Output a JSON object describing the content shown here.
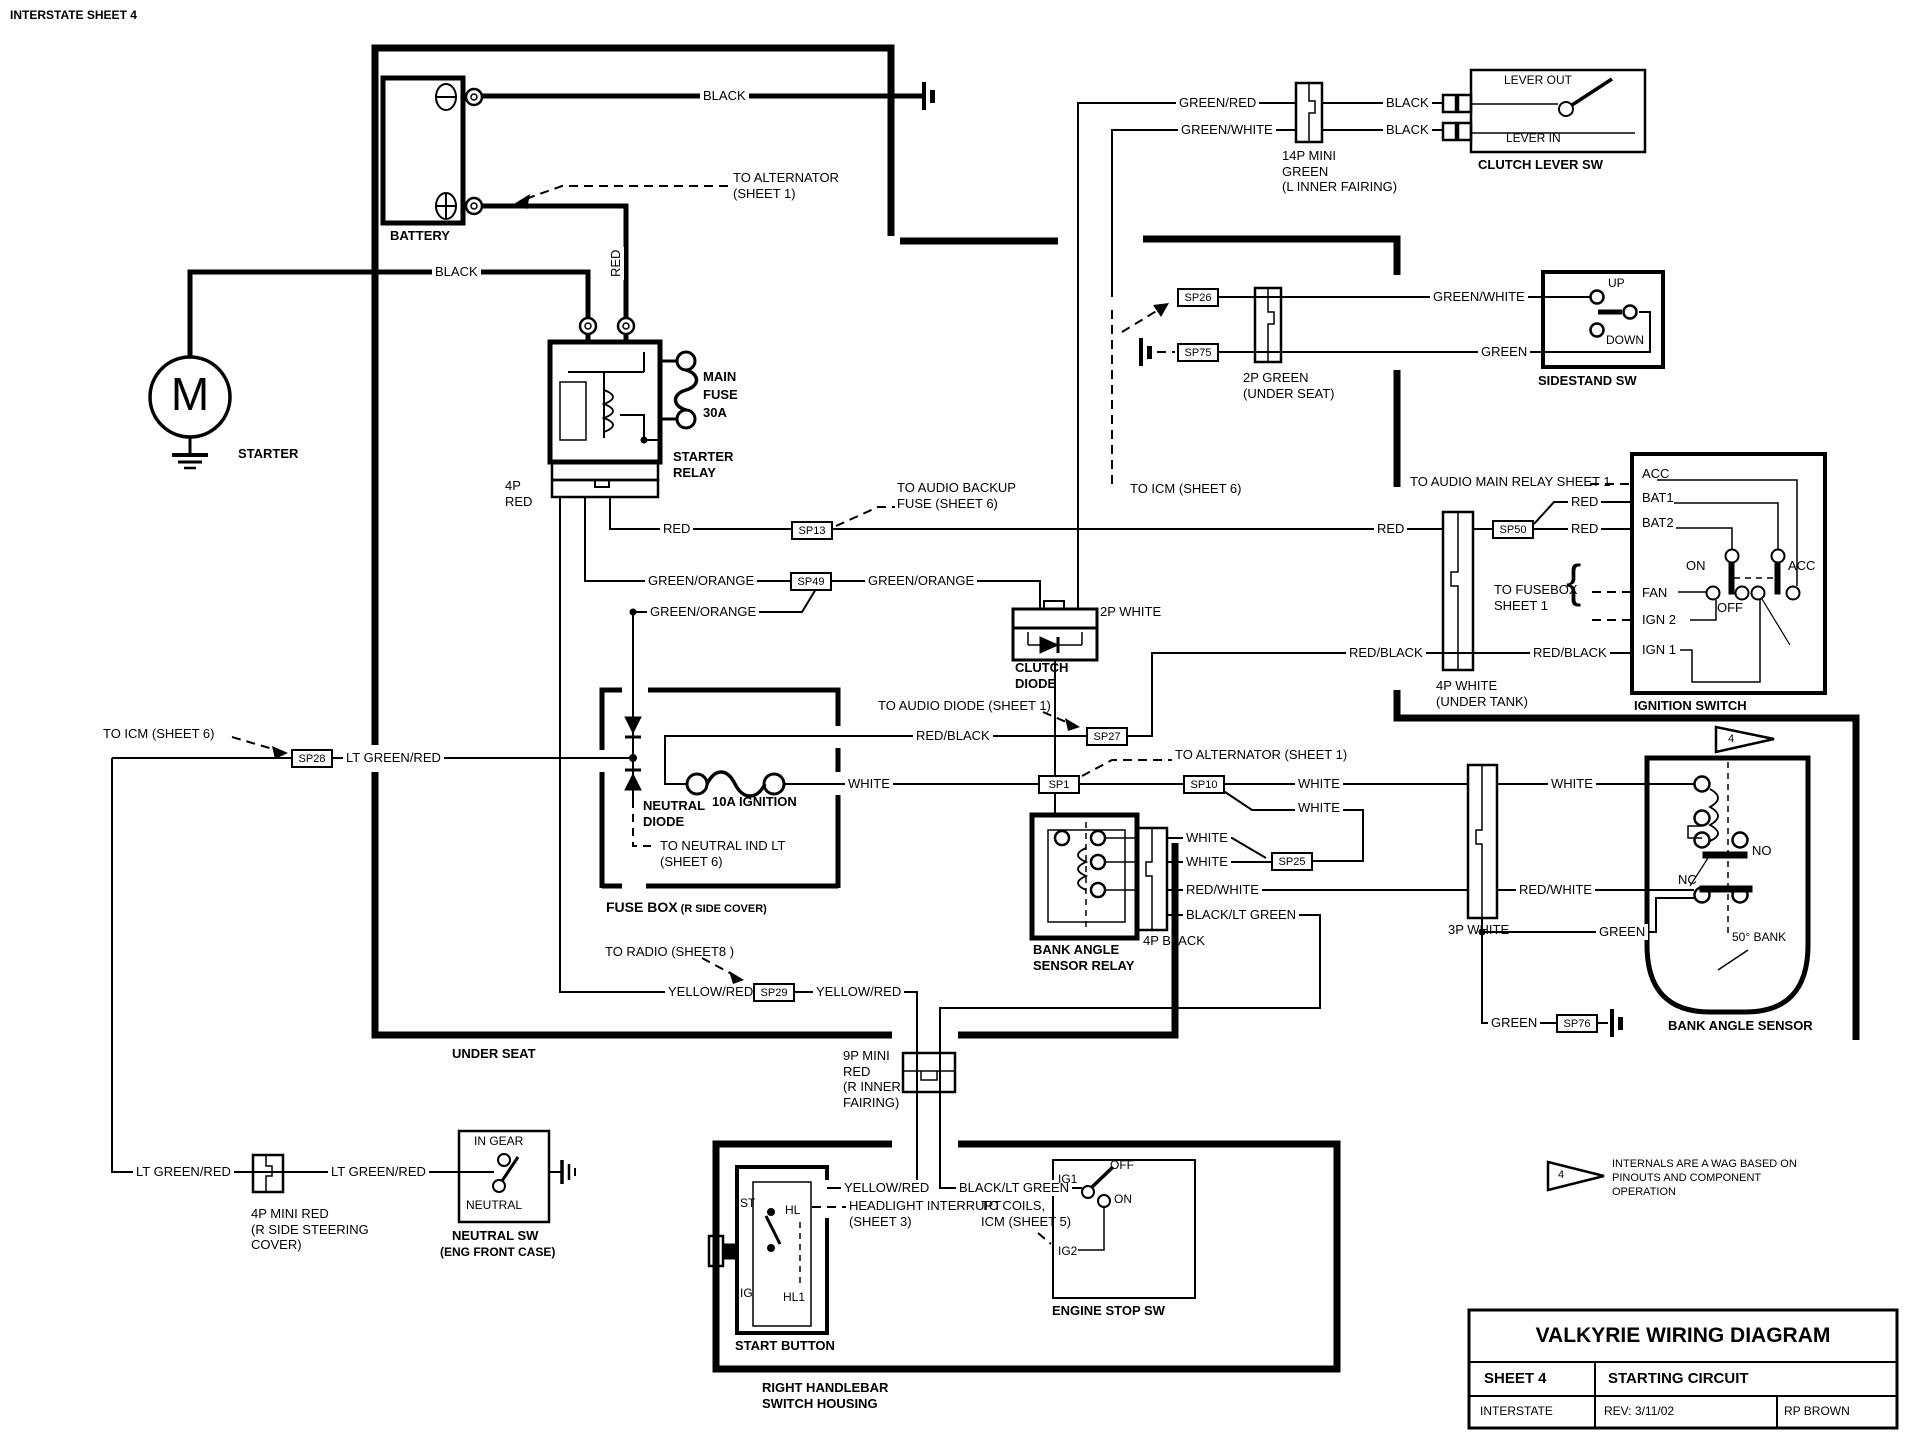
{
  "header": {
    "sheet": "INTERSTATE SHEET 4"
  },
  "battery": {
    "name": "BATTERY",
    "neg_wire": "BLACK",
    "pos_wire": "RED",
    "to_alternator": "TO ALTERNATOR\n(SHEET 1)"
  },
  "starter": {
    "name": "STARTER",
    "motor": "M",
    "wire": "BLACK"
  },
  "starter_relay": {
    "name": "STARTER\nRELAY",
    "fuse": "MAIN\nFUSE\n30A",
    "connector": "4P\nRED",
    "out_red": "RED",
    "out_go1": "GREEN/ORANGE",
    "out_go2": "GREEN/ORANGE",
    "go_right": "GREEN/ORANGE"
  },
  "splices": {
    "sp13": "SP13",
    "sp49": "SP49",
    "sp28": "SP28",
    "sp27": "SP27",
    "sp1": "SP1",
    "sp10": "SP10",
    "sp25": "SP25",
    "sp26": "SP26",
    "sp75": "SP75",
    "sp50": "SP50",
    "sp29": "SP29",
    "sp76": "SP76"
  },
  "clutch_diode": {
    "name": "CLUTCH\nDIODE",
    "connector": "2P WHITE"
  },
  "fuse_box": {
    "name": "FUSE BOX",
    "name_suffix": " (R SIDE COVER)",
    "neutral_diode": "NEUTRAL\nDIODE",
    "ignition_fuse": "10A IGNITION",
    "white": "WHITE",
    "lt_green_red": "LT GREEN/RED",
    "red_black": "RED/BLACK"
  },
  "clutch_lever": {
    "name": "CLUTCH LEVER SW",
    "lever_out": "LEVER OUT",
    "lever_in": "LEVER IN",
    "green_red": "GREEN/RED",
    "green_white": "GREEN/WHITE",
    "black1": "BLACK",
    "black2": "BLACK",
    "connector": "14P MINI\nGREEN\n(L INNER FAIRING)"
  },
  "sidestand": {
    "name": "SIDESTAND SW",
    "up": "UP",
    "down": "DOWN",
    "green_white": "GREEN/WHITE",
    "green": "GREEN",
    "connector": "2P GREEN\n(UNDER SEAT)"
  },
  "ignition": {
    "name": "IGNITION SWITCH",
    "acc": "ACC",
    "bat1": "BAT1",
    "bat2": "BAT2",
    "fan": "FAN",
    "ign2": "IGN 2",
    "ign1": "IGN 1",
    "on": "ON",
    "off": "OFF",
    "acc2": "ACC",
    "red_l": "RED",
    "red_r1": "RED",
    "red_r2": "RED",
    "red_black_l": "RED/BLACK",
    "red_black_r": "RED/BLACK",
    "connector": "4P WHITE\n(UNDER TANK)"
  },
  "mid": {
    "white_top": "WHITE",
    "white_bot": "WHITE"
  },
  "bas_relay": {
    "name": "BANK ANGLE\nSENSOR RELAY",
    "connector": "4P BLACK",
    "white1": "WHITE",
    "white2": "WHITE",
    "red_white": "RED/WHITE",
    "black_lt_green": "BLACK/LT GREEN"
  },
  "bas": {
    "name": "BANK ANGLE SENSOR",
    "connector": "3P WHITE",
    "white_r": "WHITE",
    "red_white": "RED/WHITE",
    "green_r": "GREEN",
    "green_b": "GREEN",
    "no": "NO",
    "nc": "NC",
    "bank": "50° BANK"
  },
  "under_seat": {
    "name": "UNDER SEAT",
    "yellow_red_l": "YELLOW/RED",
    "yellow_red_r": "YELLOW/RED",
    "connector": "9P MINI\nRED\n(R INNER\nFAIRING)"
  },
  "handlebar": {
    "name": "RIGHT HANDLEBAR\nSWITCH HOUSING",
    "start_button": "START BUTTON",
    "st": "ST",
    "ig": "IG",
    "hl": "HL",
    "hl1": "HL1",
    "yellow_red": "YELLOW/RED",
    "black_lt_green": "BLACK/LT GREEN"
  },
  "engine_stop": {
    "name": "ENGINE STOP SW",
    "ig1": "IG1",
    "ig2": "IG2",
    "on": "ON",
    "off": "OFF"
  },
  "neutral": {
    "name": "NEUTRAL SW",
    "name2": "(ENG FRONT CASE)",
    "in_gear": "IN GEAR",
    "neutral": "NEUTRAL",
    "lt_green_red_l": "LT GREEN/RED",
    "lt_green_red_r": "LT GREEN/RED",
    "connector": "4P MINI RED\n(R SIDE STEERING\nCOVER)"
  },
  "notes": {
    "audio_backup": "TO AUDIO BACKUP\nFUSE (SHEET 6)",
    "audio_diode": "TO AUDIO DIODE  (SHEET 1)",
    "alternator1": "TO ALTERNATOR (SHEET 1)",
    "icm6_left": "TO ICM  (SHEET 6)",
    "icm6_right": "TO ICM (SHEET 6)",
    "neutral_ind": "TO NEUTRAL IND LT\n(SHEET 6)",
    "radio": "TO RADIO  (SHEET8 )",
    "audio_main_relay": "TO AUDIO MAIN RELAY SHEET 1",
    "fusebox1": "TO FUSEBOX\nSHEET 1",
    "coils": "TO COILS,\nICM (SHEET 5)",
    "headlight": "HEADLIGHT INTERRUPT\n(SHEET 3)",
    "wag": "INTERNALS ARE A WAG BASED ON\nPINOUTS AND COMPONENT\nOPERATION",
    "brace": "{",
    "tri4a": "4",
    "tri4b": "4"
  },
  "title_block": {
    "title": "VALKYRIE WIRING DIAGRAM",
    "sheet": "SHEET 4",
    "circuit": "STARTING CIRCUIT",
    "model": "INTERSTATE",
    "rev": "REV: 3/11/02",
    "author": "RP BROWN"
  }
}
